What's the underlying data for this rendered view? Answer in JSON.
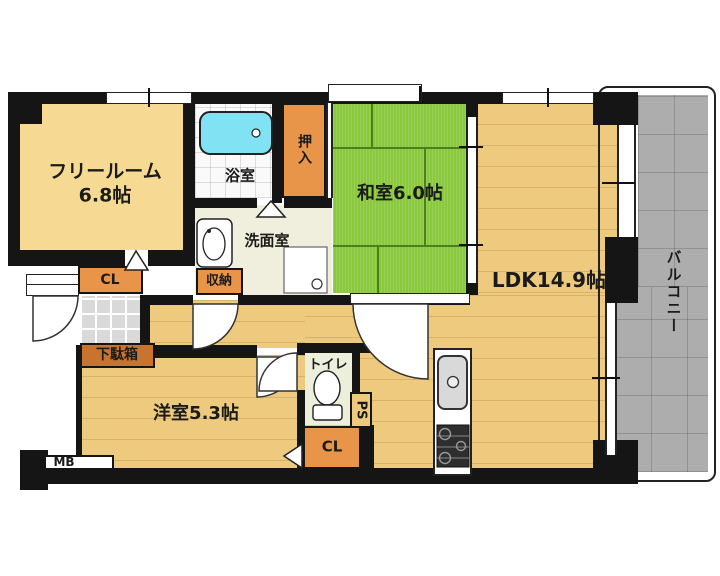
{
  "rooms": {
    "free_room": {
      "name": "フリールーム",
      "size": "6.8帖"
    },
    "washitsu": {
      "name": "和室6.0帖"
    },
    "ldk": {
      "name": "LDK14.9帖"
    },
    "youshitsu": {
      "name": "洋室5.3帖"
    },
    "balcony": {
      "name": "バルコニー"
    },
    "bathroom": {
      "name": "浴室"
    },
    "washroom": {
      "name": "洗面室"
    },
    "toilet": {
      "name": "トイレ"
    },
    "oshiire": {
      "name": "押入"
    },
    "storage": {
      "name": "収納"
    },
    "closet_entry": {
      "name": "CL"
    },
    "closet_south": {
      "name": "CL"
    },
    "shoe_cabinet": {
      "name": "下駄箱"
    },
    "pipe_space": {
      "name": "PS"
    },
    "meter_box": {
      "name": "MB"
    }
  },
  "colors": {
    "wall": "#151515",
    "cream_room": "#F6D993",
    "wood_floor": "#EDCA7E",
    "tatami_green": "#8AC83D",
    "closet_orange": "#E8954A",
    "shoe_cabinet_brown": "#C8732E",
    "balcony_gray": "#ADADAD",
    "bathtub_cyan": "#80E2F2",
    "toilet_floor": "#EBEFDC",
    "washroom_floor": "#F0EEDC"
  }
}
